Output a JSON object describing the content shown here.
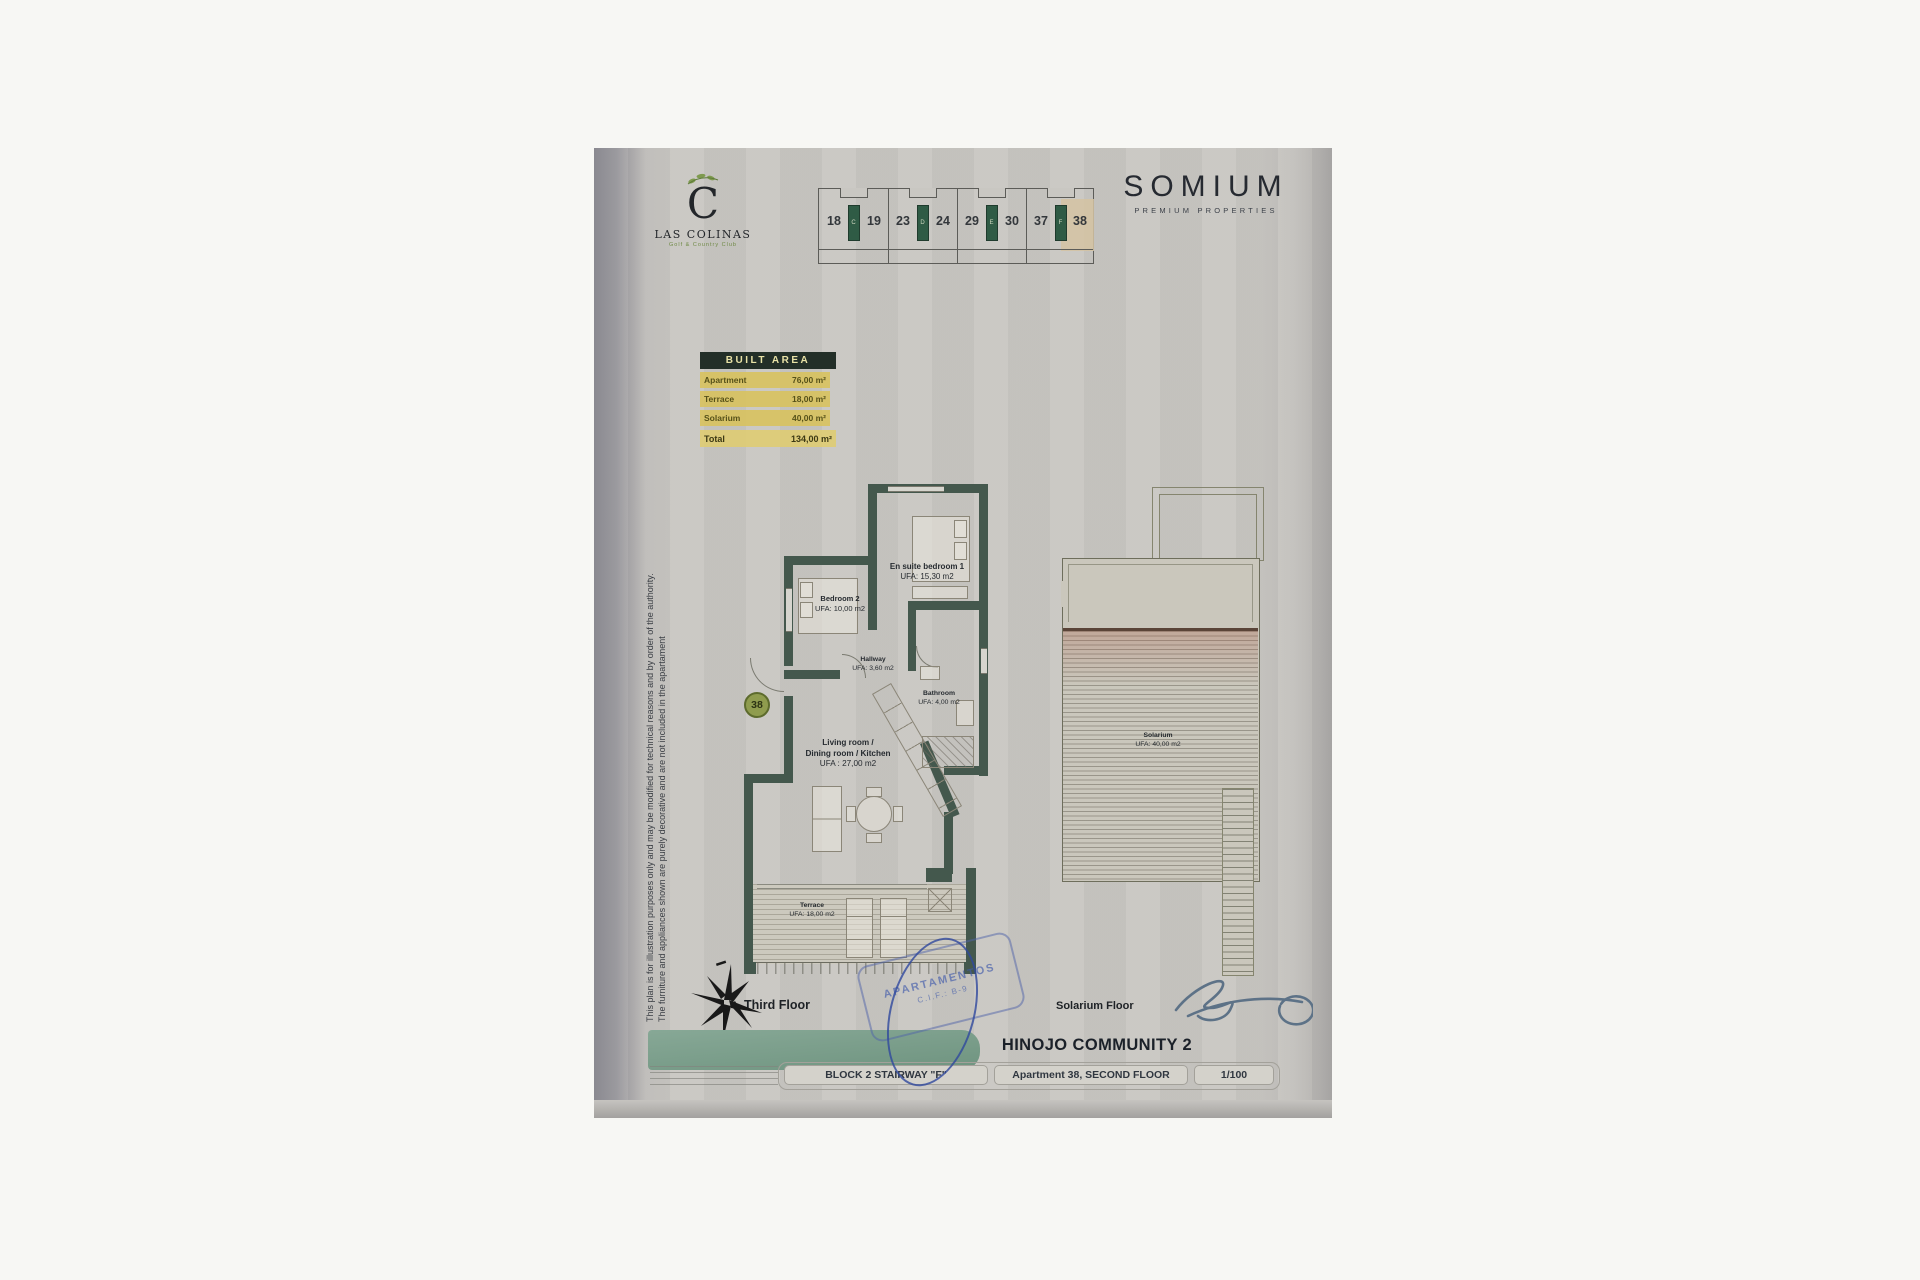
{
  "branding": {
    "las_colinas": {
      "initial": "C",
      "name": "LAS COLINAS",
      "tagline": "Golf & Country Club"
    },
    "somium": {
      "name": "SOMIUM",
      "subtitle": "PREMIUM PROPERTIES"
    }
  },
  "key_plan": {
    "units": [
      "18",
      "19",
      "23",
      "24",
      "29",
      "30",
      "37",
      "38"
    ],
    "stair_letters": [
      "C",
      "D",
      "E",
      "F"
    ],
    "highlighted_unit": "38"
  },
  "built_area": {
    "title": "BUILT AREA",
    "rows": [
      {
        "label": "Apartment",
        "value": "76,00 m²"
      },
      {
        "label": "Terrace",
        "value": "18,00 m²"
      },
      {
        "label": "Solarium",
        "value": "40,00 m²"
      }
    ],
    "total": {
      "label": "Total",
      "value": "134,00 m²"
    }
  },
  "disclaimer": {
    "line1": "This plan is for illustration purposes only and may be modified for technical reasons and by order of the authority.",
    "line2": "The furniture and appliances shown are purely decorative and are not included in the apartament"
  },
  "floor_plan": {
    "unit_badge": "38",
    "rooms": {
      "bedroom1": {
        "lines": [
          "En suite bedroom 1",
          "UFA: 15,30 m2"
        ]
      },
      "bedroom2": {
        "lines": [
          "Bedroom 2",
          "UFA: 10,00 m2"
        ]
      },
      "hallway": {
        "lines": [
          "Hallway",
          "UFA: 3,60 m2"
        ]
      },
      "bathroom": {
        "lines": [
          "Bathroom",
          "UFA: 4,00 m2"
        ]
      },
      "living": {
        "lines": [
          "Living room /",
          "Dining room / Kitchen",
          "UFA : 27,00 m2"
        ]
      },
      "terrace": {
        "lines": [
          "Terrace",
          "UFA: 18,00 m2"
        ]
      }
    },
    "caption": "Third Floor"
  },
  "solarium_plan": {
    "room": {
      "lines": [
        "Solarium",
        "UFA: 40,00 m2"
      ]
    },
    "caption": "Solarium Floor"
  },
  "title_block": {
    "community": "HINOJO COMMUNITY 2",
    "cells": [
      "BLOCK 2 STAIRWAY \"F\"",
      "Apartment 38, SECOND FLOOR",
      "1/100"
    ]
  },
  "stamp": {
    "line1": "APARTAMENTOS",
    "line2": "C.I.F.: B-9"
  }
}
